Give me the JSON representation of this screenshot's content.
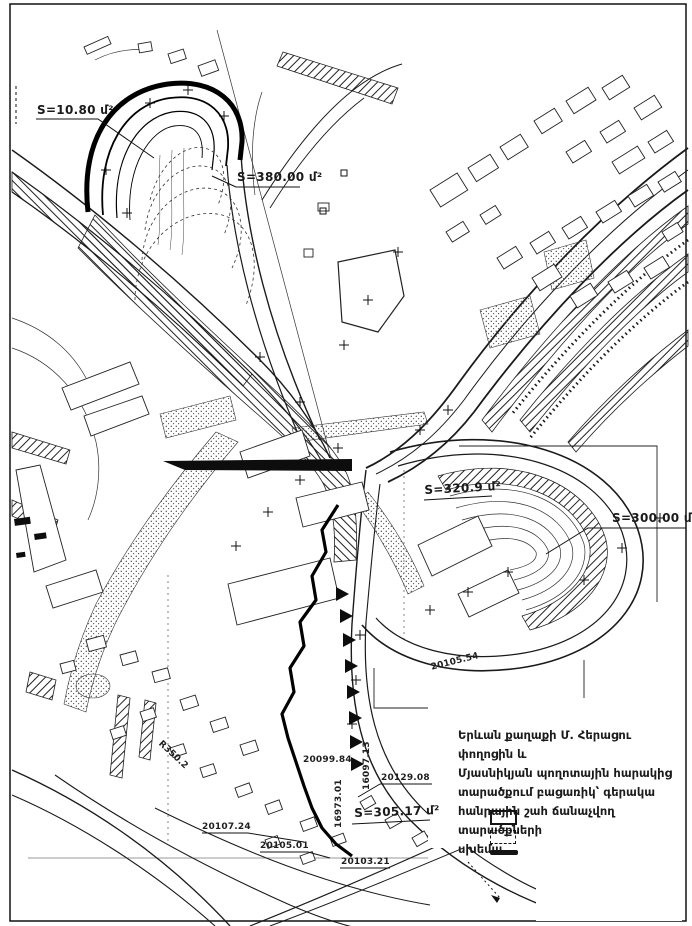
{
  "page": {
    "kind": "scanned cadastral scheme map",
    "city": "Yerevan",
    "background": "#ffffff",
    "ink_color": "#1a1a1a"
  },
  "title_block": {
    "lines": [
      "Երևան քաղաքի Մ. Հերացու փողոցին և",
      "Մյասնիկյան պողոտային հարակից",
      "տարածքում բացառիկ՝ գերակա",
      "հանրային շահ ճանաչվող տարածքների",
      "սխեմա"
    ]
  },
  "legend": {
    "items": [
      {
        "symbol": "solid-outline-rect-swatch"
      },
      {
        "symbol": "dashed-outline-rect-swatch"
      },
      {
        "symbol": "solid-black-bar-swatch"
      }
    ]
  },
  "area_labels": [
    {
      "text": "S=10.80 մ²"
    },
    {
      "text": "S=380.00 մ²"
    },
    {
      "text": "S=320.9 մ²"
    },
    {
      "text": "S=300.00 մ²"
    },
    {
      "text": "S=305.17 մ²"
    }
  ],
  "survey_numbers": [
    {
      "text": "20107.24"
    },
    {
      "text": "20129.08"
    },
    {
      "text": "20105.01"
    },
    {
      "text": "20103.21"
    },
    {
      "text": "20099.84"
    },
    {
      "text": "20105.54"
    },
    {
      "text": "16973.01"
    },
    {
      "text": "16097.13"
    },
    {
      "text": "R350.2"
    }
  ]
}
